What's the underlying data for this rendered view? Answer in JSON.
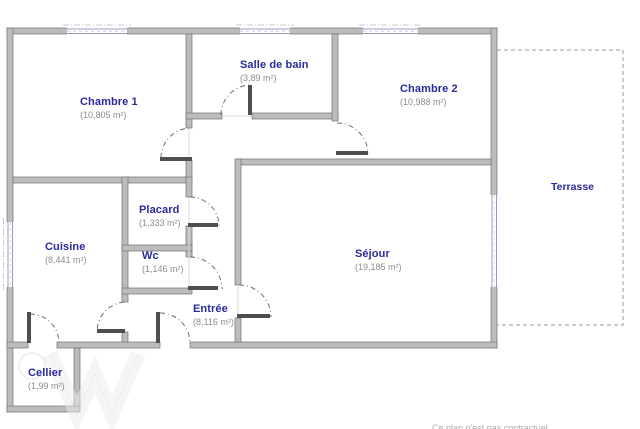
{
  "plan": {
    "rooms": [
      {
        "name": "Chambre 1",
        "area": "(10,805 m²)"
      },
      {
        "name": "Salle de bain",
        "area": "(3,89 m²)"
      },
      {
        "name": "Chambre 2",
        "area": "(10,988 m²)"
      },
      {
        "name": "Placard",
        "area": "(1,333 m²)"
      },
      {
        "name": "Wc",
        "area": "(1,146 m²)"
      },
      {
        "name": "Cuisine",
        "area": "(8,441 m²)"
      },
      {
        "name": "Entrée",
        "area": "(8,116 m²)"
      },
      {
        "name": "Séjour",
        "area": "(19,185 m²)"
      },
      {
        "name": "Cellier",
        "area": "(1,99 m²)"
      }
    ],
    "outdoor": {
      "name": "Terrasse"
    },
    "disclaimer": "Ce plan n'est pas contractuel",
    "colors": {
      "room_label": "#2a2a9e",
      "area_label": "#8c8c8c",
      "wall_fill": "#bcbcbc",
      "wall_stroke": "#777777",
      "window_line": "#9898c8",
      "door_leaf": "#4f4f4f",
      "terrace_dash": "#9a9a9a"
    }
  }
}
